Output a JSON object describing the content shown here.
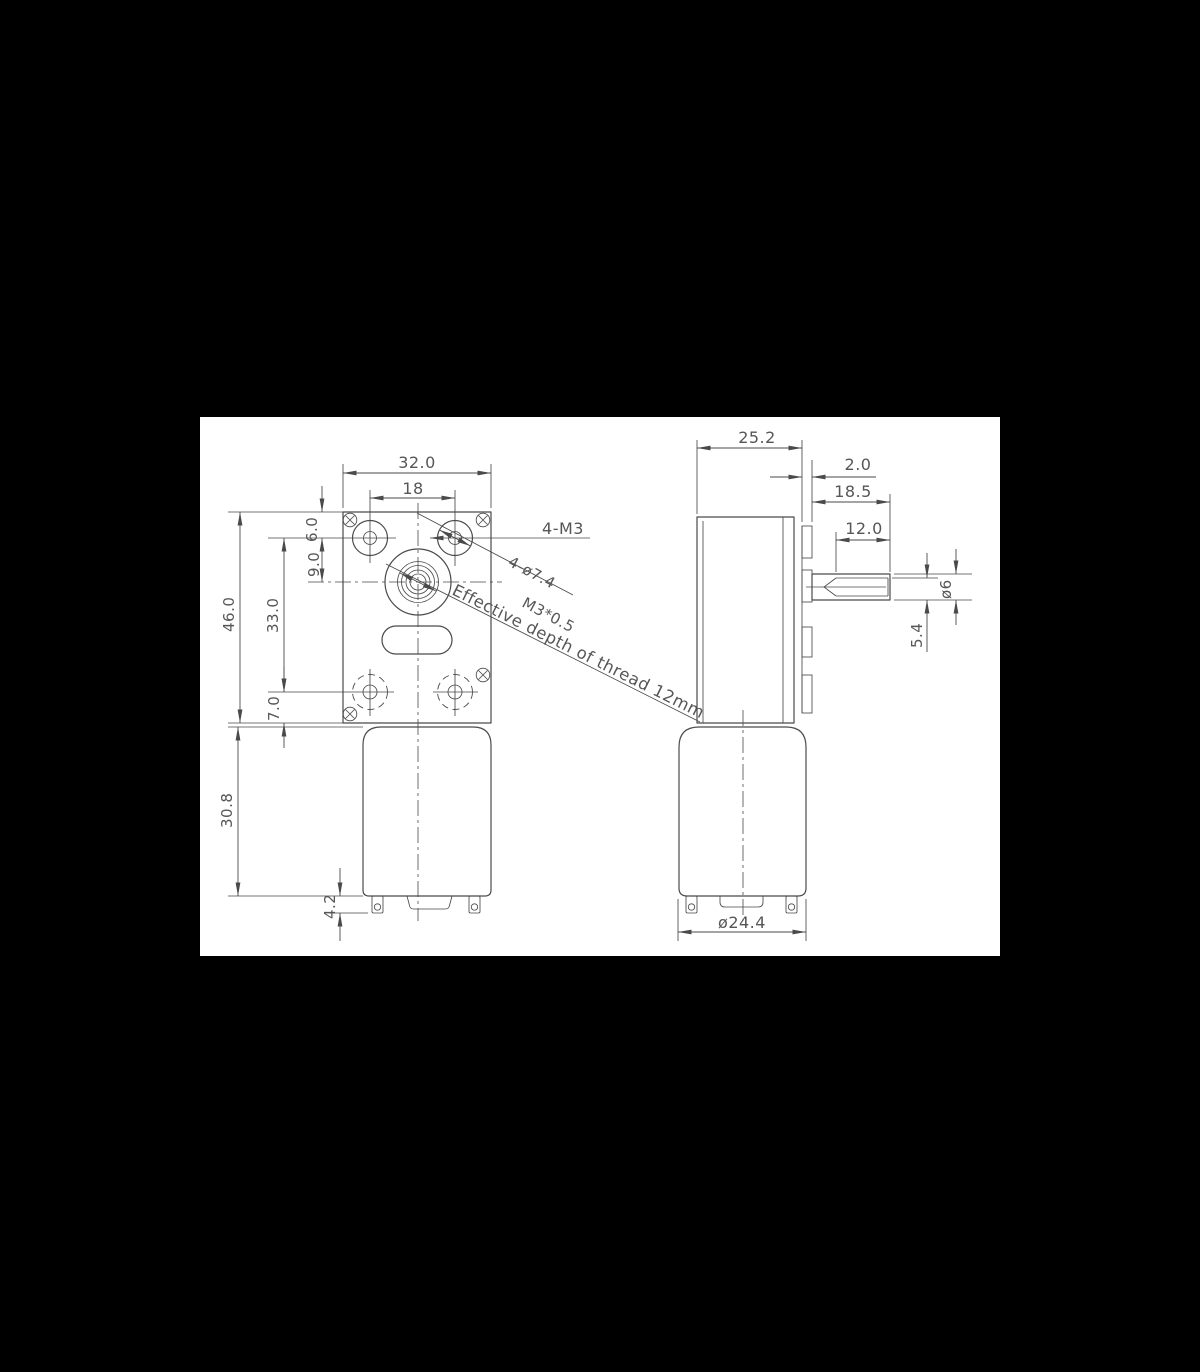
{
  "title": "Worm gear motor dimension drawing",
  "colors": {
    "canvas_background": "#000000",
    "sheet_background": "#ffffff",
    "line_color": "#4a4a4a",
    "dimension_text_color": "#565656"
  },
  "front_view": {
    "dims": {
      "overall_width": "32.0",
      "hole_spacing_h": "18",
      "overall_height": "46.0",
      "top_to_holes": "6.0",
      "holes_to_shaft": "9.0",
      "hole_spacing_v": "33.0",
      "holes_to_bottom": "7.0",
      "motor_length": "30.8",
      "terminal_length": "4.2"
    },
    "notes": {
      "mounting_screws": "4-M3",
      "boss_diameter": "4-ø7.4",
      "thread_spec": "M3*0.5",
      "thread_depth": "Effective depth of thread 12mm"
    }
  },
  "side_view": {
    "dims": {
      "body_depth": "25.2",
      "flange_thickness": "2.0",
      "shaft_length": "18.5",
      "flat_length": "12.0",
      "shaft_diameter": "ø6",
      "shaft_flat_height": "5.4",
      "motor_diameter": "ø24.4"
    }
  }
}
